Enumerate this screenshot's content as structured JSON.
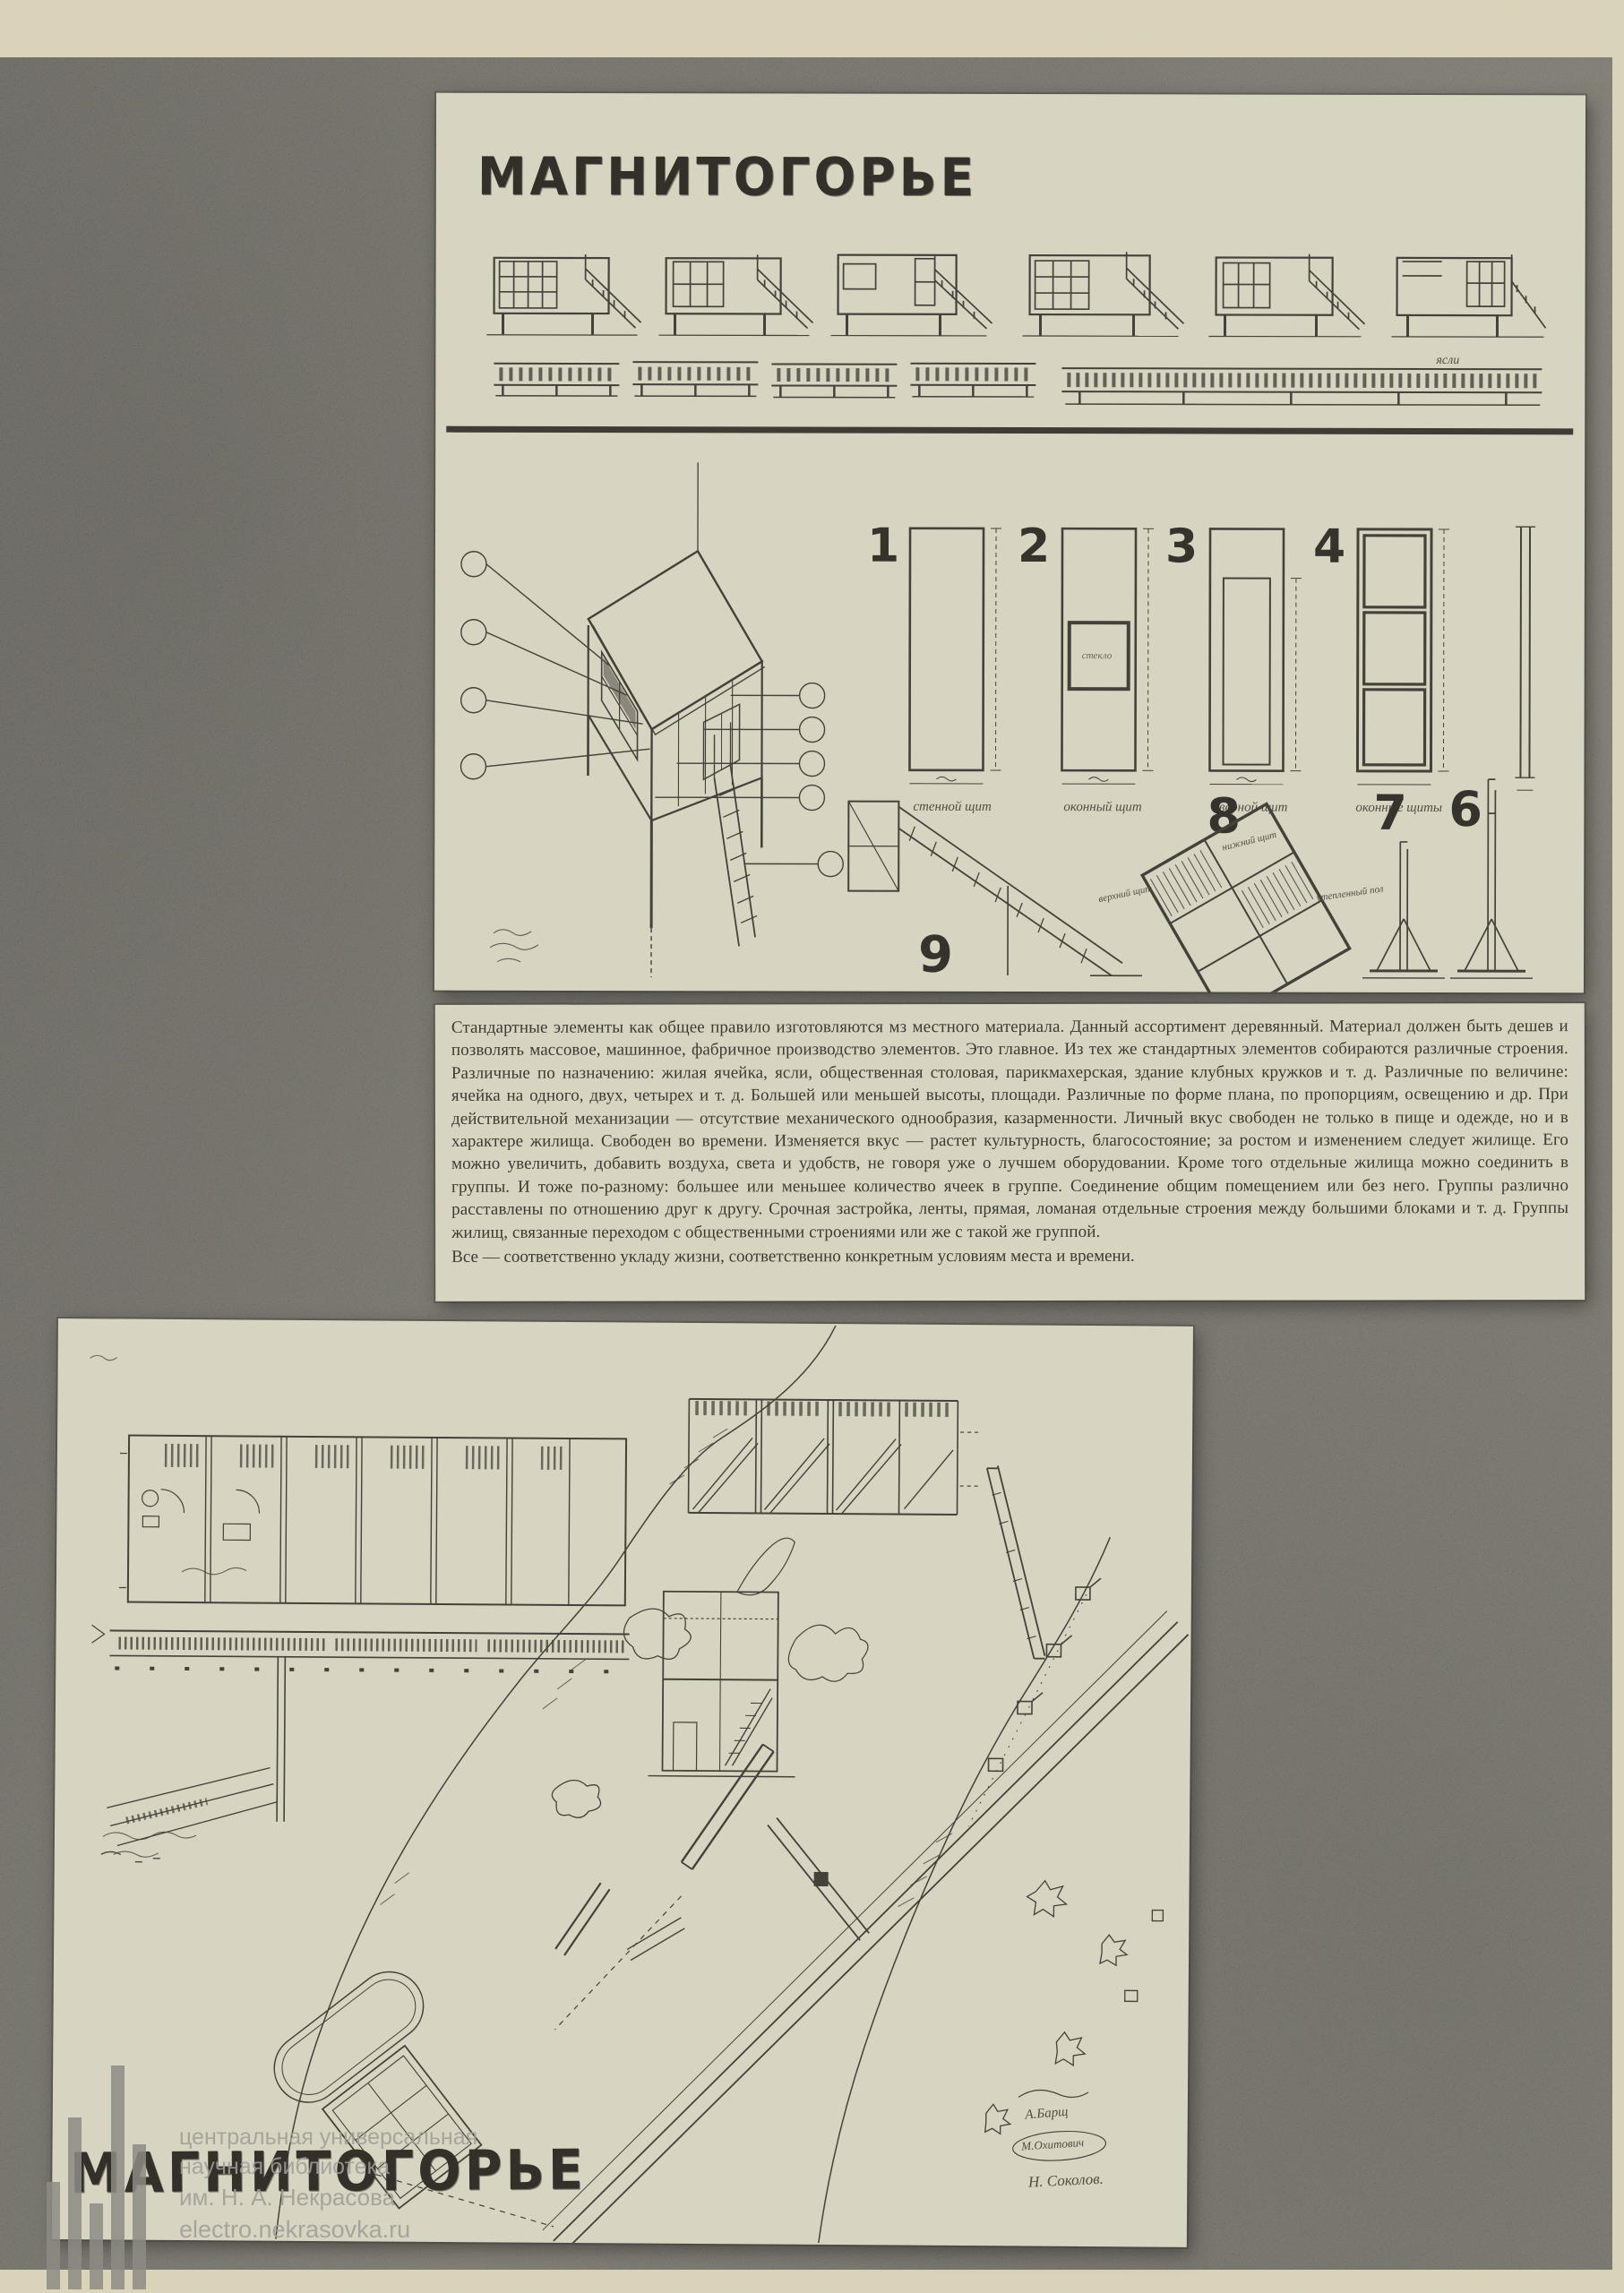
{
  "page": {
    "background_color": "#3a3833",
    "paper_color": "#d9d2b6",
    "panel_color": "#d7d3c0",
    "ink_color": "#2c2922"
  },
  "top_panel": {
    "title": "МАГНИТОГОРЬЕ",
    "yasli_label": "ясли",
    "numerals": {
      "n1": "1",
      "n2": "2",
      "n3": "3",
      "n4": "4",
      "n6": "6",
      "n7": "7",
      "n8": "8",
      "n9": "9"
    },
    "captions": [
      "стенной щит",
      "оконный щит",
      "дверной щит",
      "оконные щиты"
    ],
    "glass_label": "стекло",
    "frame_labels": {
      "top": "нижний щит",
      "left": "верхний щит",
      "right": "утепленный пол"
    }
  },
  "text_block": {
    "paragraph": "Стандартные элементы как общее правило изготовляются мз местного материала. Данный ассортимент деревянный. Материал должен быть дешев и позволять массовое, машинное, фабричное производство элементов. Это главное. Из тех же стандартных элементов собираются различные строения. Различные по назначению: жилая ячейка, ясли, общественная столовая, парикмахерская, здание клубных кружков и т. д. Различные по величине: ячейка на одного, двух, четырех и т. д. Большей или меньшей высоты, площади. Различные по форме плана, по пропорциям, освещению и др. При действительной механизации — отсутствие механического однообразия, казарменности. Личный вкус свободен не только в пище и одежде, но и в характере жилища. Свободен во времени. Изменяется вкус — растет культурность, благосостояние; за ростом и изменением следует жилище. Его можно увеличить, добавить воздуха, света и удобств, не говоря уже о лучшем оборудовании. Кроме того отдельные жилища можно соединить в группы. И тоже по-разному: большее или меньшее количество ячеек в группе. Соединение общим помещением или без него. Группы различно расставлены по отношению друг к другу. Срочная застройка, ленты, прямая, ломаная отдельные строения между большими блоками и т. д. Группы жилищ, связанные переходом с общественными строениями или же с такой же группой.",
    "closing_line": "Все — соответственно укладу жизни, соответственно конкретным условиям места и времени."
  },
  "bottom_panel": {
    "title": "МАГНИТОГОРЬЕ",
    "signatures": [
      "А.Барщ",
      "М.Охитович",
      "Н. Соколов."
    ]
  },
  "watermark": {
    "lines": [
      "центральная универсальная",
      "научная библиотека",
      "им. Н. А. Некрасова",
      "electro.nekrasovka.ru"
    ]
  }
}
